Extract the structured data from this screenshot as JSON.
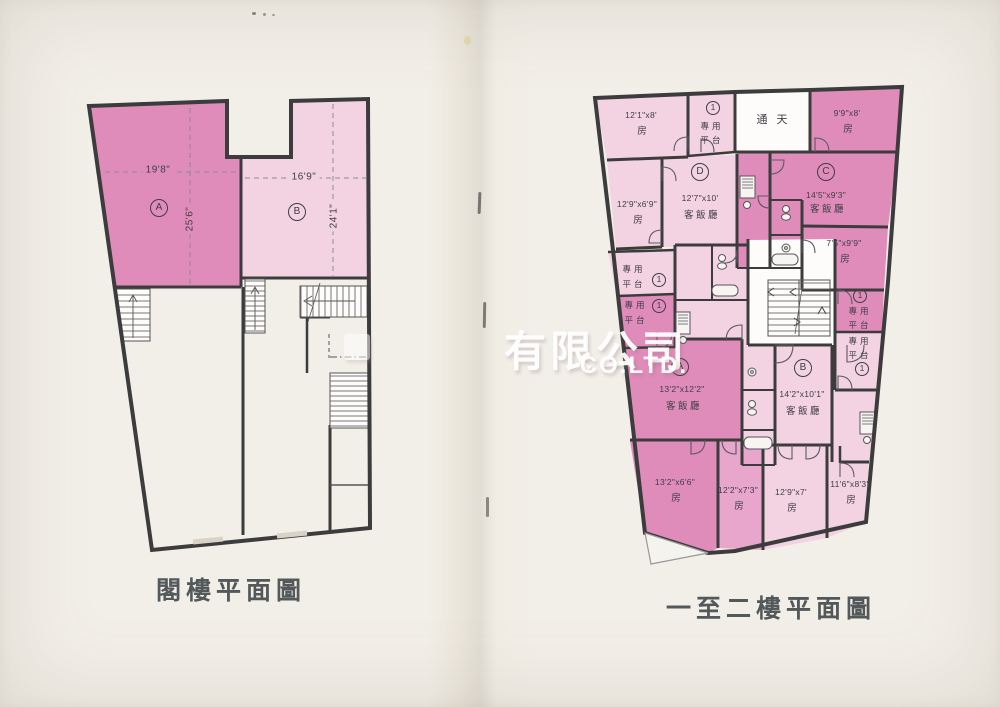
{
  "page": {
    "background_color": "#f2efe8",
    "watermark": {
      "cjk": "有限公司",
      "latin": "CO.LTD."
    }
  },
  "left_plan": {
    "caption": "閣樓平面圖",
    "units": [
      {
        "marker": "A",
        "width": "19'8\"",
        "depth": "25'6\""
      },
      {
        "marker": "B",
        "width": "16'9\"",
        "depth": "24'1\""
      }
    ]
  },
  "right_plan": {
    "caption": "一至二樓平面圖",
    "skylight": "通天",
    "platform": {
      "line1": "專用",
      "line2": "平台",
      "number": "1"
    },
    "units": [
      {
        "marker": "D",
        "dims": "12'7\"x10'",
        "type": "客飯廳"
      },
      {
        "marker": "C",
        "dims": "14'5\"x9'3\"",
        "type": "客飯廳"
      },
      {
        "marker": "A",
        "dims": "13'2\"x12'2\"",
        "type": "客飯廳"
      },
      {
        "marker": "B",
        "dims": "14'2\"x10'1\"",
        "type": "客飯廳"
      }
    ],
    "bedrooms": [
      {
        "dims": "12'1\"x8'",
        "type": "房"
      },
      {
        "dims": "9'9\"x8'",
        "type": "房"
      },
      {
        "dims": "12'9\"x6'9\"",
        "type": "房"
      },
      {
        "dims": "7'5\"x9'9\"",
        "type": "房"
      },
      {
        "dims": "13'2\"x6'6\"",
        "type": "房"
      },
      {
        "dims": "12'2\"x7'3\"",
        "type": "房"
      },
      {
        "dims": "12'9\"x7'",
        "type": "房"
      },
      {
        "dims": "11'6\"x8'3\"",
        "type": "房"
      }
    ]
  },
  "colors": {
    "room_dark": "#e08cba",
    "room_mid": "#e8a6cc",
    "room_light": "#f3d3e2",
    "wall": "#3c3c3c"
  }
}
